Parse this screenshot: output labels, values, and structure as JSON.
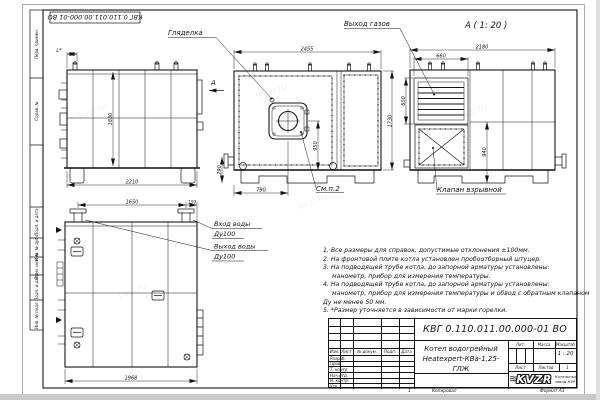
{
  "watermark": "kvzr.ru",
  "frame": {
    "stamp_rotated": "КВГ 0.110.011.00.000-01 ВО",
    "margin_labels": [
      "Перв. примен.",
      "Справ. №",
      "Подп. и дата",
      "Инв. № дубл.",
      "Взам. инв. №",
      "Подп. и дата",
      "Инв. № подл."
    ]
  },
  "views": {
    "side": {
      "dim_l": "L*",
      "dim_height": "1830",
      "dim_width": "2210",
      "section_mark": "А"
    },
    "front": {
      "label_peephole": "Гляделка",
      "label_see_item": "См.п.2",
      "dim_width": "2455",
      "dim_height": "1730",
      "dim_burner": "950",
      "dim_base": "290",
      "dim_burner_x": "790"
    },
    "view_a": {
      "title": "А ( 1: 20 )",
      "label_gas_outlet": "Выход газов",
      "label_valve": "Клапан взрывной",
      "dim_width": "2180",
      "dim_louver_w": "660",
      "dim_louver_h": "600",
      "dim_h": "940"
    },
    "plan": {
      "label_water_in": "Вход воды",
      "label_water_in_dn": "Ду100",
      "label_water_out": "Выход воды",
      "label_water_out_dn": "Ду100",
      "dim_a": "1650",
      "dim_b": "159",
      "dim_width": "1968"
    }
  },
  "notes": {
    "lines": [
      "1. Все размеры для справок, допустимые отклонения ±100мм.",
      "2. На фронтовой плите котла установлен пробоотборный штуцер.",
      "3. На подводящей трубе котла, до запорной арматуры установлены:",
      "манометр, прибор для измерения температуры.",
      "4. На подводящей трубе котла, до запорной арматуры установлены:",
      "манометр, прибор для измерения температуры и обвод с обратным клапаном",
      "Ду не менее 50 мм.",
      "5. *Размер уточняется в зависимости от марки горелки."
    ]
  },
  "titleblock": {
    "doc_number": "КВГ 0.110.011.00.000-01 ВО",
    "name_line1": "Котел водогрейный",
    "name_line2": "Heatexpert-КВа-1,25-ГЛЖ",
    "header_cols": [
      "Изм.",
      "Лист",
      "№ докум.",
      "Подп.",
      "Дата"
    ],
    "sign_rows": [
      "Разраб.",
      "Пров.",
      "Т. контр.",
      "Нач.отд.",
      "Н. контр.",
      "Утв."
    ],
    "lit_label": "Лит.",
    "mass_label": "Масса",
    "scale_label": "Масштаб",
    "scale_value": "1 : 20",
    "sheet_label": "Лист",
    "sheets_label": "Листов",
    "sheets_value": "1",
    "logo_waves_glyph": "≋",
    "logo_text": "KVZR",
    "company_line1": "Котельный",
    "company_line2": "завод КЗР",
    "footer_num": "1",
    "footer_copy": "Копировал",
    "footer_format": "Формат А3"
  }
}
